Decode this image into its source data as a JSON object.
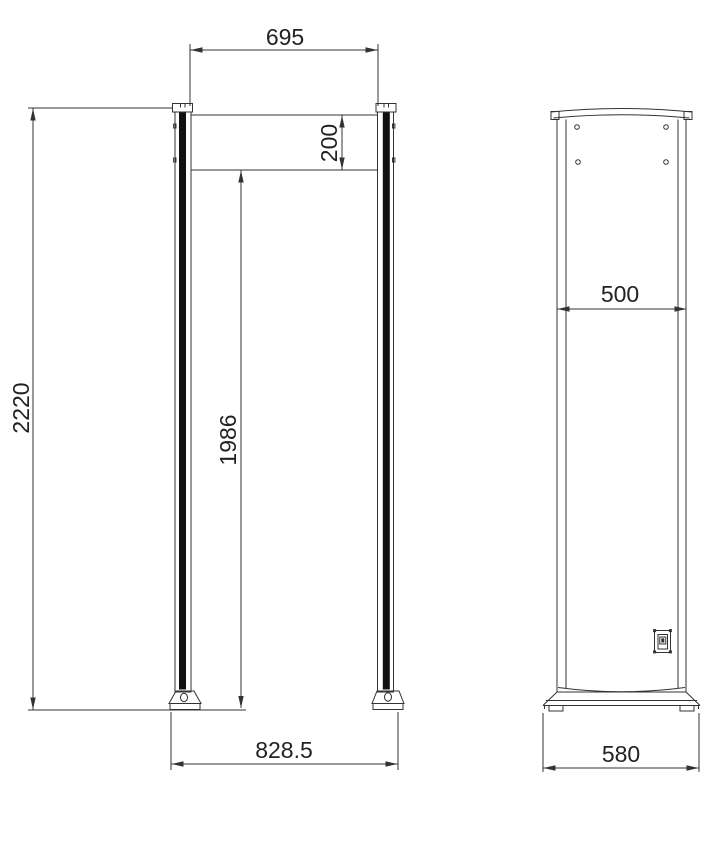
{
  "drawing": {
    "type": "technical outline drawing, walk-through security gate, front and side views",
    "line_color": "#333333",
    "panel_color": "#111111",
    "background": "#ffffff",
    "front_view": {
      "dim_top_width": "695",
      "dim_header_height": "200",
      "dim_total_height": "2220",
      "dim_inner_height": "1986",
      "dim_base_width": "828.5"
    },
    "side_view": {
      "dim_panel_width": "500",
      "dim_base_depth": "580"
    }
  }
}
